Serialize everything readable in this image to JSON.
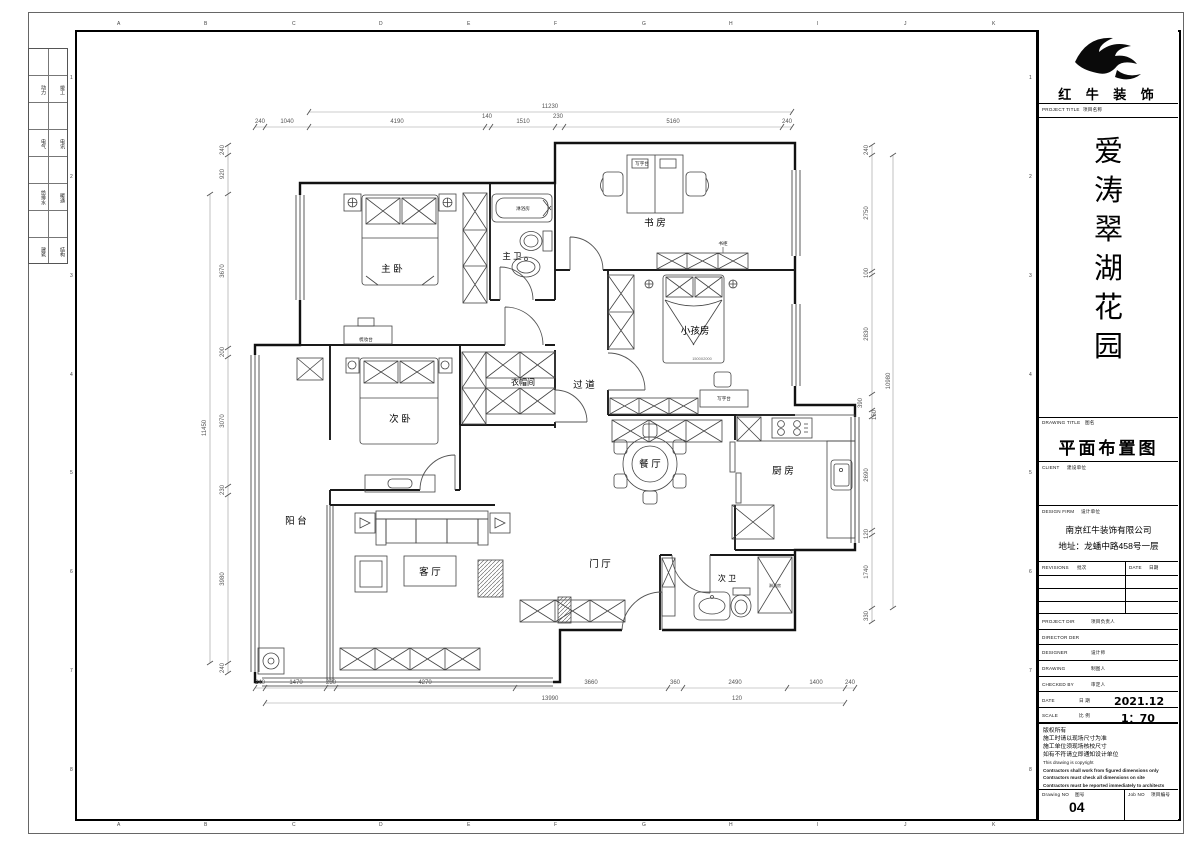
{
  "sheet": {
    "ruler_letters": [
      "A",
      "B",
      "C",
      "D",
      "E",
      "F",
      "G",
      "H",
      "I",
      "J",
      "K"
    ],
    "ruler_numbers": [
      "1",
      "2",
      "3",
      "4",
      "5",
      "6",
      "7",
      "8"
    ],
    "discipline_rows": [
      {
        "left": "动力",
        "right": "竣工"
      },
      {
        "left": "电气",
        "right": "电讯"
      },
      {
        "left": "给排水",
        "right": "暖通"
      },
      {
        "left": "建筑",
        "right": "结构"
      }
    ]
  },
  "title_block": {
    "company_name": "红 牛 装 饰",
    "project_title_label": "PROJECT TITLE",
    "project_title_label_cn": "项目名称",
    "project_name_chars": [
      "爱",
      "涛",
      "翠",
      "湖",
      "花",
      "园"
    ],
    "drawing_title_label": "DRAWING TITLE",
    "drawing_title_label_cn": "图名",
    "drawing_title": "平面布置图",
    "client_label": "CLIENT",
    "client_label_cn": "建设单位",
    "design_firm_label": "DESIGN FIRM",
    "design_firm_label_cn": "设计单位",
    "design_firm_name": "南京红牛装饰有限公司",
    "design_firm_address": "地址：龙蟠中路458号一层",
    "revisions_label": "REVISIONS",
    "revisions_label_cn": "批次",
    "revisions_date_label": "DATE",
    "revisions_date_label_cn": "日期",
    "project_dir_label": "PROJECT DIR",
    "project_dir_label_cn": "项目负责人",
    "director_label": "DIRECTOR DER",
    "designer_label": "DESIGNER",
    "designer_label_cn": "设计师",
    "drawing_label": "DRAWING",
    "drawing_label_cn": "制图人",
    "checked_label": "CHECKED BY",
    "checked_label_cn": "审定人",
    "date_label": "DATE",
    "date_label_cn": "日 期",
    "date_value": "2021.12",
    "scale_label": "SCALE",
    "scale_label_cn": "比 例",
    "scale_value": "1：70",
    "notes": [
      "版权所有",
      "施工时请以现场尺寸为准",
      "施工单位须现场核校尺寸",
      "如有不符请立即通知设计单位",
      "This drawing is copyright",
      "Contractors shall work from figured dimensions only",
      "Contractors must check all dimensions on site",
      "Contractors must be reported immediately to architects"
    ],
    "drawing_no_label": "Drawing NO",
    "drawing_no_label_cn": "图号",
    "drawing_no": "04",
    "job_no_label": "Job NO",
    "job_no_label_cn": "项目编号"
  },
  "plan": {
    "rooms": {
      "master_bedroom": "主 卧",
      "master_bath": "主 卫",
      "study": "书 房",
      "kids_room": "小孩房",
      "corridor": "过 道",
      "cloakroom": "衣帽间",
      "second_bedroom": "次 卧",
      "balcony": "阳 台",
      "living_room": "客 厅",
      "dining_room": "餐 厅",
      "kitchen": "厨 房",
      "foyer": "门 厅",
      "second_bath": "次 卫"
    },
    "furniture_labels": {
      "desk_study": "写字台",
      "desk_kids": "写字台",
      "bookcase": "书柜",
      "dresser": "梳妆台",
      "shower_master": "淋浴房",
      "shower_second": "淋浴房",
      "bed_size": "1500X2000"
    },
    "dimensions": {
      "top": {
        "total": "11230",
        "segments": [
          "240",
          "1040",
          "4190",
          "140",
          "1510",
          "230",
          "5160",
          "240"
        ]
      },
      "bottom": {
        "total": "13990",
        "offset": "120",
        "segments": [
          "240",
          "1470",
          "230",
          "4270",
          "3660",
          "360",
          "2490",
          "1400",
          "240"
        ]
      },
      "left": {
        "total": "11450",
        "segments": [
          "240",
          "920",
          "3670",
          "200",
          "3070",
          "230",
          "3980",
          "240"
        ]
      },
      "right": {
        "total": "10980",
        "segments": [
          "240",
          "2750",
          "100",
          "2830",
          "390",
          "150",
          "2690",
          "120",
          "1740",
          "330"
        ]
      }
    }
  }
}
